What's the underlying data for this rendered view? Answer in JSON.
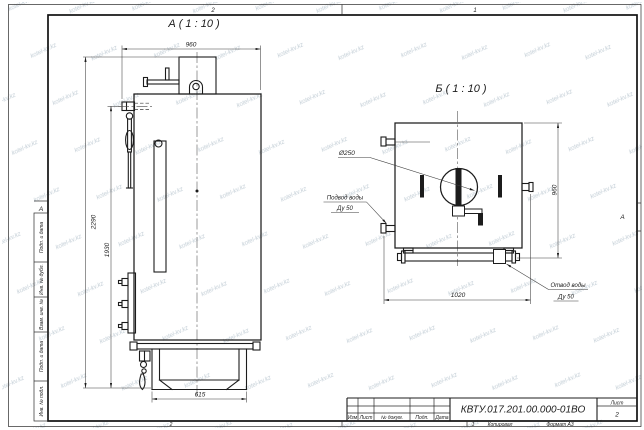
{
  "watermark": {
    "text": "kotel-kv.kz"
  },
  "frame": {
    "zones": {
      "top_left": "2",
      "top_right": "1",
      "bottom_left": "2",
      "bottom_right": "1",
      "left_row": "А",
      "right_row": "А"
    },
    "footer": {
      "copied": "Копировал",
      "format": "Формат А3"
    }
  },
  "sidebar": {
    "fields": [
      "Подп. и дата",
      "Инв. № дубл.",
      "Взам. инв. №",
      "Подп. и дата",
      "Инв. № подл."
    ]
  },
  "title_block": {
    "cols": [
      "Изм",
      "Лист",
      "№ докум.",
      "Подп.",
      "Дата"
    ],
    "designation": "КВТУ.017.201.00.000-01ВО",
    "sheet_label": "Лист",
    "sheet_number": "2"
  },
  "front_view": {
    "label": "А ( 1 : 10 )",
    "dim_width": "960",
    "dim_height_total": "2290",
    "dim_height_body": "1930",
    "dim_base": "615"
  },
  "side_view": {
    "label": "Б ( 1 : 10 )",
    "dim_width": "1020",
    "dim_height": "960",
    "dim_flue": "Ø250",
    "inlet": {
      "line1": "Подвод воды",
      "line2": "Ду 50"
    },
    "outlet": {
      "line1": "Отвод воды",
      "line2": "Ду 50"
    }
  }
}
